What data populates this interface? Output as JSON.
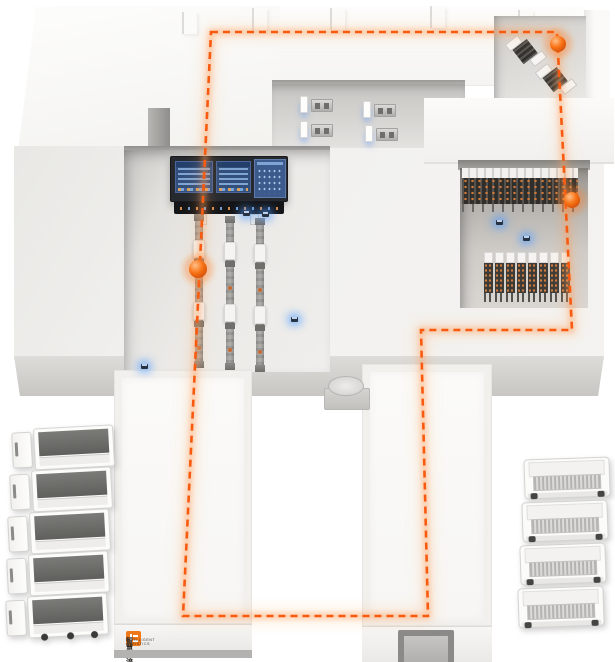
{
  "scene": {
    "name": "smart-warehouse-logistics-isometric-diagram",
    "colors": {
      "route_orange": "#f85a10",
      "route_glow": "#ff9b57",
      "node_orange": "#f97316",
      "sensor_blue": "#4d9bff",
      "screen_panel_blue": "#35507e",
      "logo_orange": "#f07818",
      "floor_light": "#f2f1ef",
      "rack_dark": "#3e3b37"
    },
    "logo": {
      "line1": "智慧物流",
      "line2": "INTELLIGENT LOGISTICS"
    },
    "agv_path": {
      "points": [
        [
          211,
          32
        ],
        [
          557,
          32
        ],
        [
          572,
          330
        ],
        [
          421,
          330
        ],
        [
          428,
          616
        ],
        [
          183,
          616
        ]
      ],
      "dash": "7 5",
      "stroke_width": 2.6
    },
    "route_nodes": [
      {
        "x": 558,
        "y": 44,
        "r": 8
      },
      {
        "x": 572,
        "y": 200,
        "r": 8
      },
      {
        "x": 198,
        "y": 269,
        "r": 9
      }
    ],
    "sensors": [
      {
        "x": 141,
        "y": 364
      },
      {
        "x": 291,
        "y": 317
      },
      {
        "x": 243,
        "y": 211
      },
      {
        "x": 262,
        "y": 212
      },
      {
        "x": 496,
        "y": 220
      },
      {
        "x": 523,
        "y": 236
      }
    ],
    "wall_notches": [
      {
        "x": 182,
        "y": 12
      },
      {
        "x": 252,
        "y": 8
      },
      {
        "x": 330,
        "y": 8
      },
      {
        "x": 430,
        "y": 6
      },
      {
        "x": 518,
        "y": 10
      }
    ],
    "workstations": [
      {
        "x": 300,
        "y": 96
      },
      {
        "x": 363,
        "y": 101
      },
      {
        "x": 300,
        "y": 121
      },
      {
        "x": 365,
        "y": 125
      }
    ],
    "machines_top_right": [
      {
        "x": 513,
        "y": 33,
        "rot": -38
      },
      {
        "x": 543,
        "y": 61,
        "rot": -38
      }
    ],
    "conveyor_lines": [
      {
        "x": 193,
        "y": 214
      },
      {
        "x": 224,
        "y": 216
      },
      {
        "x": 254,
        "y": 218
      }
    ],
    "storage_racks": [
      {
        "x": 484,
        "y": 252
      },
      {
        "x": 495,
        "y": 252
      },
      {
        "x": 506,
        "y": 252
      },
      {
        "x": 517,
        "y": 252
      },
      {
        "x": 528,
        "y": 252
      },
      {
        "x": 539,
        "y": 252
      },
      {
        "x": 550,
        "y": 252
      },
      {
        "x": 561,
        "y": 252
      }
    ],
    "trucks_left": [
      {
        "x": 12,
        "y": 427,
        "rot": -3
      },
      {
        "x": 10,
        "y": 469,
        "rot": -3
      },
      {
        "x": 8,
        "y": 511,
        "rot": -3
      },
      {
        "x": 7,
        "y": 553,
        "rot": -3
      },
      {
        "x": 6,
        "y": 595,
        "rot": -3,
        "wheels": true
      }
    ],
    "trucks_right": [
      {
        "x": 524,
        "y": 458,
        "rot": -2
      },
      {
        "x": 522,
        "y": 501,
        "rot": -2
      },
      {
        "x": 520,
        "y": 544,
        "rot": -2
      },
      {
        "x": 518,
        "y": 587,
        "rot": -2,
        "wheels": true
      }
    ]
  }
}
